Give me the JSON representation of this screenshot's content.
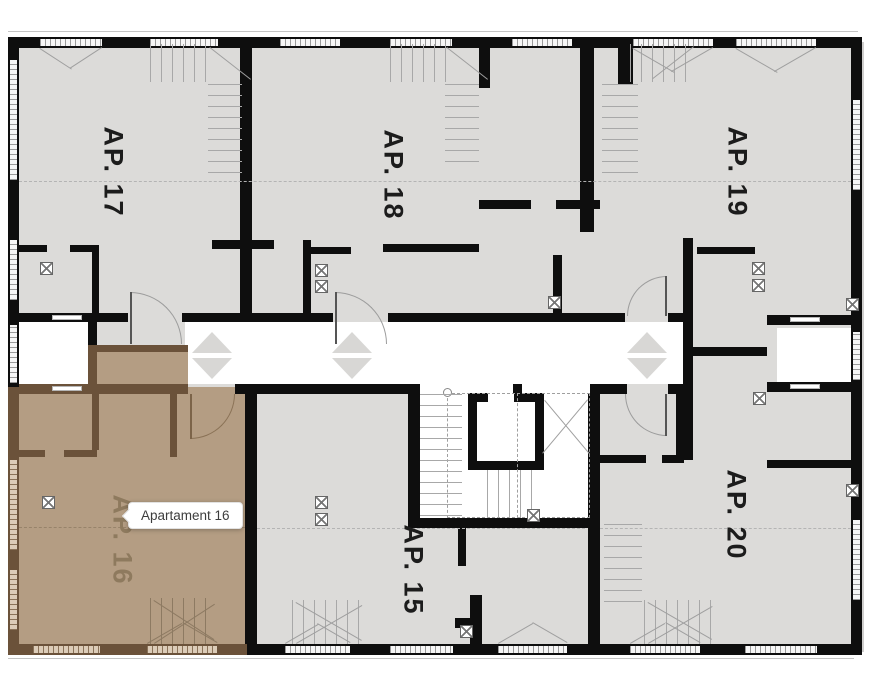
{
  "floor_plan": {
    "apartments": [
      {
        "id": "ap-17",
        "label": "AP. 17",
        "highlighted": false
      },
      {
        "id": "ap-18",
        "label": "AP. 18",
        "highlighted": false
      },
      {
        "id": "ap-19",
        "label": "AP. 19",
        "highlighted": false
      },
      {
        "id": "ap-16",
        "label": "AP. 16",
        "highlighted": true
      },
      {
        "id": "ap-15",
        "label": "AP. 15",
        "highlighted": false
      },
      {
        "id": "ap-20",
        "label": "AP. 20",
        "highlighted": false
      }
    ],
    "tooltip": {
      "text": "Apartament 16",
      "target": "ap-16"
    },
    "colors": {
      "background": "#ffffff",
      "room_fill": "#dcdbd9",
      "wall": "#0e0e0e",
      "highlight_fill": "#b49d83",
      "highlight_wall": "#6b523a",
      "highlight_label": "#8e7a5e",
      "label": "#1c1c1c",
      "corridor": "#ffffff",
      "arrow": "#d8d7d5"
    },
    "icons": {
      "corridor_arrows_up": "arrow-up-icon",
      "corridor_arrows_down": "arrow-down-icon",
      "shaft_boxes": "shaft-hatch-icon"
    }
  }
}
